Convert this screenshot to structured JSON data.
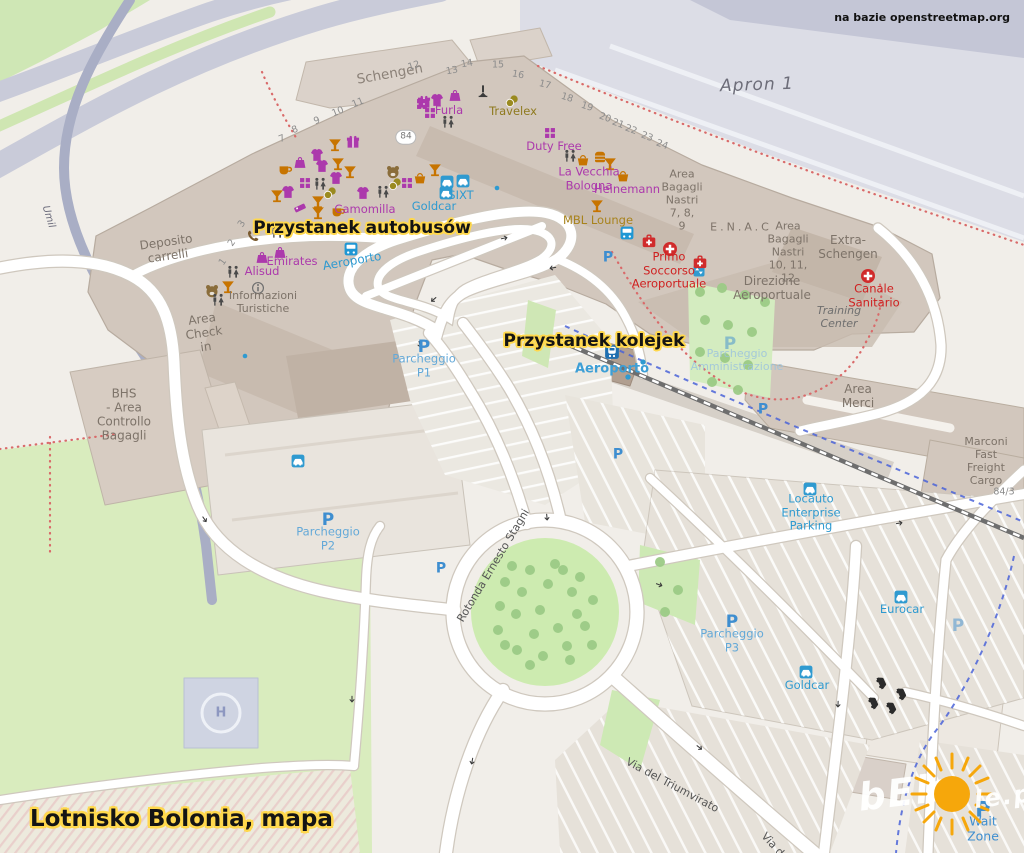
{
  "title": "Lotnisko Bolonia, mapa",
  "attribution": "na bazie openstreetmap.org",
  "annotations": {
    "bus_stop": "Przystanek autobusów",
    "train_stop": "Przystanek kolejek"
  },
  "watermark": {
    "left": "bEls",
    "right": "le.pl",
    "sun_color": "#f6a70b"
  },
  "map": {
    "labels": [
      {
        "id": "schengen",
        "text": "Schengen",
        "x": 390,
        "y": 75,
        "cls": "b-lg",
        "rot": -10
      },
      {
        "id": "deposito-carrelli",
        "text": "Deposito\ncarrelli",
        "x": 167,
        "y": 249,
        "cls": "b",
        "rot": -8
      },
      {
        "id": "area-check-in",
        "text": "Area\nCheck\nin",
        "x": 204,
        "y": 333,
        "cls": "b",
        "rot": -8
      },
      {
        "id": "informazioni-turistiche",
        "text": "Informazioni\nTuristiche",
        "x": 263,
        "y": 303,
        "cls": "b-sm"
      },
      {
        "id": "bhs-area-controllo-bagagli",
        "text": "BHS\n- Area\nControllo\nBagagli",
        "x": 124,
        "y": 415,
        "cls": "b"
      },
      {
        "id": "area-bagagli-nastri-789",
        "text": "Area\nBagagli\nNastri\n7, 8,\n9",
        "x": 682,
        "y": 201,
        "cls": "b-sm"
      },
      {
        "id": "enac",
        "text": "E.N.A.C",
        "x": 741,
        "y": 228,
        "cls": "b-sp"
      },
      {
        "id": "area-bagagli-nastri-101112",
        "text": "Area\nBagagli\nNastri\n10, 11,\n12",
        "x": 788,
        "y": 253,
        "cls": "b-sm"
      },
      {
        "id": "extra-schengen",
        "text": "Extra-\nSchengen",
        "x": 848,
        "y": 247,
        "cls": "b"
      },
      {
        "id": "direzione-aeroportuale",
        "text": "Direzione\nAeroportuale",
        "x": 772,
        "y": 288,
        "cls": "b"
      },
      {
        "id": "training-center",
        "text": "Training\nCenter",
        "x": 839,
        "y": 318,
        "cls": "b-it"
      },
      {
        "id": "area-merci",
        "text": "Area\nMerci",
        "x": 858,
        "y": 396,
        "cls": "b"
      },
      {
        "id": "marconi-fast-freight-cargo",
        "text": "Marconi\nFast\nFreight\nCargo",
        "x": 986,
        "y": 462,
        "cls": "b-sm"
      },
      {
        "id": "apron-1",
        "text": "Apron 1",
        "x": 757,
        "y": 85,
        "cls": "apron",
        "rot": -2
      },
      {
        "id": "ref-84",
        "text": "84",
        "x": 406,
        "y": 137,
        "cls": "refbadge"
      },
      {
        "id": "ref-84-3",
        "text": "84/3",
        "x": 1004,
        "y": 492,
        "cls": "ref-sm"
      },
      {
        "id": "via-del-triumvirato",
        "text": "Via del Triumvirato",
        "x": 672,
        "y": 786,
        "cls": "road",
        "rot": 28
      },
      {
        "id": "rotonda-ernesto-stagni",
        "text": "Rotonda Ernesto Stagni",
        "x": 494,
        "y": 566,
        "cls": "road",
        "rot": -59
      },
      {
        "id": "umil-road",
        "text": "Umil",
        "x": 48,
        "y": 217,
        "cls": "road-it",
        "rot": 73
      },
      {
        "id": "via-d",
        "text": "Via d",
        "x": 772,
        "y": 845,
        "cls": "road",
        "rot": 48
      },
      {
        "id": "wait-zone",
        "text": "Wait Zone",
        "x": 983,
        "y": 829,
        "cls": "blue-lbl"
      },
      {
        "id": "furla",
        "text": "Furla",
        "x": 449,
        "y": 111,
        "cls": "shop"
      },
      {
        "id": "duty-free",
        "text": "Duty Free",
        "x": 554,
        "y": 147,
        "cls": "shop"
      },
      {
        "id": "la-vecchia-bologna",
        "text": "La Vecchia\nBologna",
        "x": 589,
        "y": 179,
        "cls": "shop"
      },
      {
        "id": "heinemann",
        "text": "Heinemann",
        "x": 627,
        "y": 190,
        "cls": "shop"
      },
      {
        "id": "camomilla",
        "text": "Camomilla",
        "x": 365,
        "y": 210,
        "cls": "shop"
      },
      {
        "id": "emirates",
        "text": "Emirates",
        "x": 292,
        "y": 262,
        "cls": "shop"
      },
      {
        "id": "alisud",
        "text": "Alisud",
        "x": 262,
        "y": 272,
        "cls": "shop"
      },
      {
        "id": "travelex",
        "text": "Travelex",
        "x": 513,
        "y": 112,
        "cls": "money"
      },
      {
        "id": "mbl-lounge",
        "text": "MBL Lounge",
        "x": 598,
        "y": 221,
        "cls": "gold"
      },
      {
        "id": "sixt",
        "text": "SIXT",
        "x": 461,
        "y": 196,
        "cls": "rental"
      },
      {
        "id": "goldcar-terminal",
        "text": "Goldcar",
        "x": 434,
        "y": 207,
        "cls": "rental"
      },
      {
        "id": "locauto-enterprise-parking",
        "text": "Locauto\nEnterprise\nParking",
        "x": 811,
        "y": 513,
        "cls": "rental"
      },
      {
        "id": "eurocar",
        "text": "Eurocar",
        "x": 902,
        "y": 610,
        "cls": "rental"
      },
      {
        "id": "goldcar-south",
        "text": "Goldcar",
        "x": 807,
        "y": 686,
        "cls": "rental"
      },
      {
        "id": "aeroporto-bus-stop",
        "text": "Aeroporto",
        "x": 352,
        "y": 261,
        "cls": "transit",
        "rot": -10
      },
      {
        "id": "aeroporto-train-station",
        "text": "Aeroporto",
        "x": 612,
        "y": 369,
        "cls": "transit-lg"
      },
      {
        "id": "parcheggio-p1",
        "text": "Parcheggio\nP1",
        "x": 424,
        "y": 366,
        "cls": "park"
      },
      {
        "id": "parcheggio-p2",
        "text": "Parcheggio\nP2",
        "x": 328,
        "y": 539,
        "cls": "park"
      },
      {
        "id": "parcheggio-p3",
        "text": "Parcheggio\nP3",
        "x": 732,
        "y": 641,
        "cls": "park"
      },
      {
        "id": "parcheggio-amministrazione",
        "text": "Parcheggio\nAmministrazione",
        "x": 737,
        "y": 361,
        "cls": "park-faint"
      },
      {
        "id": "primo-soccorso-aeroportuale",
        "text": "Primo\nSoccorso\nAeroportuale",
        "x": 669,
        "y": 271,
        "cls": "med"
      },
      {
        "id": "canale-sanitario",
        "text": "Canale\nSanitario",
        "x": 874,
        "y": 296,
        "cls": "med"
      },
      {
        "id": "helipad-h",
        "text": "H",
        "x": 221,
        "y": 713,
        "cls": "heli"
      },
      {
        "id": "p-icon-p1",
        "text": "P",
        "x": 424,
        "y": 347,
        "cls": "picon"
      },
      {
        "id": "p-icon-p2",
        "text": "P",
        "x": 328,
        "y": 520,
        "cls": "picon"
      },
      {
        "id": "p-icon-p3",
        "text": "P",
        "x": 732,
        "y": 622,
        "cls": "picon"
      },
      {
        "id": "p-icon-wait-zone",
        "text": "P",
        "x": 983,
        "y": 810,
        "cls": "picon picon-lg"
      },
      {
        "id": "p-icon-admin",
        "text": "P",
        "x": 730,
        "y": 344,
        "cls": "picon picon-faint"
      },
      {
        "id": "p-icon-station",
        "text": "P",
        "x": 608,
        "y": 258,
        "cls": "picon picon-sm"
      },
      {
        "id": "p-icon-merci",
        "text": "P",
        "x": 763,
        "y": 410,
        "cls": "picon picon-sm"
      },
      {
        "id": "p-icon-mid-lot",
        "text": "P",
        "x": 618,
        "y": 455,
        "cls": "picon picon-sm"
      },
      {
        "id": "p-icon-p2-west",
        "text": "P",
        "x": 441,
        "y": 569,
        "cls": "picon picon-sm"
      },
      {
        "id": "p-icon-rental-depot",
        "text": "P",
        "x": 958,
        "y": 626,
        "cls": "picon picon-faint"
      }
    ],
    "gates": [
      {
        "n": "1",
        "x": 223,
        "y": 262,
        "r": -55
      },
      {
        "n": "2",
        "x": 232,
        "y": 243,
        "r": -55
      },
      {
        "n": "3",
        "x": 242,
        "y": 224,
        "r": -55
      },
      {
        "n": "7",
        "x": 282,
        "y": 139,
        "r": -22
      },
      {
        "n": "8",
        "x": 295,
        "y": 130,
        "r": -22
      },
      {
        "n": "9",
        "x": 317,
        "y": 121,
        "r": -22
      },
      {
        "n": "10",
        "x": 338,
        "y": 112,
        "r": -22
      },
      {
        "n": "11",
        "x": 358,
        "y": 103,
        "r": -22
      },
      {
        "n": "12",
        "x": 414,
        "y": 66,
        "r": -18
      },
      {
        "n": "13",
        "x": 452,
        "y": 71,
        "r": -10
      },
      {
        "n": "14",
        "x": 467,
        "y": 64,
        "r": -10
      },
      {
        "n": "15",
        "x": 498,
        "y": 65,
        "r": 0
      },
      {
        "n": "16",
        "x": 518,
        "y": 75,
        "r": 10
      },
      {
        "n": "17",
        "x": 545,
        "y": 85,
        "r": 14
      },
      {
        "n": "18",
        "x": 567,
        "y": 98,
        "r": 18
      },
      {
        "n": "19",
        "x": 587,
        "y": 107,
        "r": 18
      },
      {
        "n": "20",
        "x": 605,
        "y": 118,
        "r": 20
      },
      {
        "n": "21",
        "x": 618,
        "y": 124,
        "r": 20
      },
      {
        "n": "22",
        "x": 631,
        "y": 130,
        "r": 20
      },
      {
        "n": "23",
        "x": 647,
        "y": 137,
        "r": 20
      },
      {
        "n": "24",
        "x": 662,
        "y": 145,
        "r": 20
      }
    ],
    "icons": [
      {
        "t": "gift",
        "x": 353,
        "y": 142,
        "c": "#ac39ac"
      },
      {
        "t": "gift",
        "x": 424,
        "y": 102,
        "c": "#ac39ac"
      },
      {
        "t": "shirt",
        "x": 317,
        "y": 155,
        "c": "#ac39ac"
      },
      {
        "t": "shirt",
        "x": 322,
        "y": 166,
        "c": "#ac39ac"
      },
      {
        "t": "shirt",
        "x": 336,
        "y": 178,
        "c": "#ac39ac"
      },
      {
        "t": "shirt",
        "x": 288,
        "y": 192,
        "c": "#ac39ac"
      },
      {
        "t": "shirt",
        "x": 363,
        "y": 193,
        "c": "#ac39ac"
      },
      {
        "t": "shirt",
        "x": 437,
        "y": 100,
        "c": "#ac39ac"
      },
      {
        "t": "bag",
        "x": 300,
        "y": 162,
        "c": "#ac39ac"
      },
      {
        "t": "bag",
        "x": 455,
        "y": 95,
        "c": "#ac39ac"
      },
      {
        "t": "bag",
        "x": 280,
        "y": 252,
        "c": "#ac39ac"
      },
      {
        "t": "bag",
        "x": 262,
        "y": 257,
        "c": "#ac39ac"
      },
      {
        "t": "grid",
        "x": 305,
        "y": 183,
        "c": "#ac39ac",
        "s": 11
      },
      {
        "t": "grid",
        "x": 407,
        "y": 183,
        "c": "#ac39ac",
        "s": 11
      },
      {
        "t": "grid",
        "x": 422,
        "y": 104,
        "c": "#ac39ac",
        "s": 11
      },
      {
        "t": "grid",
        "x": 430,
        "y": 113,
        "c": "#ac39ac",
        "s": 11
      },
      {
        "t": "grid",
        "x": 550,
        "y": 133,
        "c": "#ac39ac",
        "s": 11
      },
      {
        "t": "tag",
        "x": 300,
        "y": 208,
        "c": "#ac39ac"
      },
      {
        "t": "cocktail",
        "x": 335,
        "y": 145,
        "c": "#c77400"
      },
      {
        "t": "cocktail",
        "x": 338,
        "y": 164,
        "c": "#c77400"
      },
      {
        "t": "cocktail",
        "x": 350,
        "y": 172,
        "c": "#c77400"
      },
      {
        "t": "cocktail",
        "x": 277,
        "y": 196,
        "c": "#c77400"
      },
      {
        "t": "cocktail",
        "x": 318,
        "y": 202,
        "c": "#c77400"
      },
      {
        "t": "cocktail",
        "x": 318,
        "y": 213,
        "c": "#c77400"
      },
      {
        "t": "cocktail",
        "x": 228,
        "y": 287,
        "c": "#c77400"
      },
      {
        "t": "cocktail",
        "x": 435,
        "y": 170,
        "c": "#c77400"
      },
      {
        "t": "cocktail",
        "x": 597,
        "y": 206,
        "c": "#c77400"
      },
      {
        "t": "cocktail",
        "x": 610,
        "y": 164,
        "c": "#c77400"
      },
      {
        "t": "cup",
        "x": 285,
        "y": 169,
        "c": "#c77400"
      },
      {
        "t": "cup",
        "x": 338,
        "y": 211,
        "c": "#c77400"
      },
      {
        "t": "basket",
        "x": 420,
        "y": 178,
        "c": "#c77400",
        "s": 12
      },
      {
        "t": "basket",
        "x": 583,
        "y": 160,
        "c": "#c77400",
        "s": 12
      },
      {
        "t": "basket",
        "x": 623,
        "y": 176,
        "c": "#c77400",
        "s": 12
      },
      {
        "t": "burger",
        "x": 600,
        "y": 157,
        "c": "#c77400",
        "s": 12
      },
      {
        "t": "bear",
        "x": 393,
        "y": 172,
        "c": "#8a6d3b",
        "s": 15
      },
      {
        "t": "bear",
        "x": 212,
        "y": 291,
        "c": "#8a6d3b",
        "s": 15
      },
      {
        "t": "coins",
        "x": 330,
        "y": 193,
        "c": "#9a8a1f"
      },
      {
        "t": "coins",
        "x": 395,
        "y": 184,
        "c": "#9a8a1f"
      },
      {
        "t": "coins",
        "x": 512,
        "y": 101,
        "c": "#9a8a1f"
      },
      {
        "t": "wc",
        "x": 320,
        "y": 184,
        "c": "#4a4a4a"
      },
      {
        "t": "wc",
        "x": 383,
        "y": 192,
        "c": "#4a4a4a"
      },
      {
        "t": "wc",
        "x": 448,
        "y": 122,
        "c": "#4a4a4a"
      },
      {
        "t": "wc",
        "x": 570,
        "y": 156,
        "c": "#4a4a4a"
      },
      {
        "t": "wc",
        "x": 277,
        "y": 232,
        "c": "#4a4a4a"
      },
      {
        "t": "wc",
        "x": 233,
        "y": 272,
        "c": "#4a4a4a"
      },
      {
        "t": "wc",
        "x": 218,
        "y": 300,
        "c": "#4a4a4a"
      },
      {
        "t": "phone",
        "x": 253,
        "y": 236,
        "c": "#7a5b30"
      },
      {
        "t": "monument",
        "x": 483,
        "y": 91,
        "c": "#3a3a3a"
      },
      {
        "t": "info",
        "x": 258,
        "y": 288,
        "c": "#6f6f6f"
      },
      {
        "t": "bus",
        "x": 351,
        "y": 249,
        "c": "#1f97d4",
        "s": 14
      },
      {
        "t": "bus",
        "x": 627,
        "y": 233,
        "c": "#1f97d4",
        "s": 14
      },
      {
        "t": "train",
        "x": 612,
        "y": 352,
        "c": "#1f6fb0",
        "s": 15
      },
      {
        "t": "lift",
        "x": 699,
        "y": 271,
        "c": "#2f9ad0",
        "s": 12
      },
      {
        "t": "cross",
        "x": 670,
        "y": 249,
        "c": "#d02b2b",
        "s": 15
      },
      {
        "t": "cross",
        "x": 868,
        "y": 276,
        "c": "#d02b2b",
        "s": 15
      },
      {
        "t": "kit",
        "x": 649,
        "y": 241,
        "c": "#d02b2b",
        "s": 14
      },
      {
        "t": "kit",
        "x": 700,
        "y": 262,
        "c": "#d02b2b",
        "s": 14
      },
      {
        "t": "car",
        "x": 447,
        "y": 182,
        "c": "#2f9ad0",
        "s": 14
      },
      {
        "t": "car",
        "x": 463,
        "y": 181,
        "c": "#2f9ad0",
        "s": 14
      },
      {
        "t": "car",
        "x": 446,
        "y": 193,
        "c": "#2f9ad0",
        "s": 14
      },
      {
        "t": "car",
        "x": 298,
        "y": 461,
        "c": "#2f9ad0",
        "s": 14
      },
      {
        "t": "car",
        "x": 810,
        "y": 489,
        "c": "#2f9ad0",
        "s": 14
      },
      {
        "t": "car",
        "x": 901,
        "y": 597,
        "c": "#2f9ad0",
        "s": 14
      },
      {
        "t": "car",
        "x": 806,
        "y": 672,
        "c": "#2f9ad0",
        "s": 14
      },
      {
        "t": "carblack",
        "x": 883,
        "y": 682,
        "c": "#2b2b2b",
        "s": 13,
        "r": 65
      },
      {
        "t": "carblack",
        "x": 903,
        "y": 693,
        "c": "#2b2b2b",
        "s": 13,
        "r": 65
      },
      {
        "t": "carblack",
        "x": 875,
        "y": 702,
        "c": "#2b2b2b",
        "s": 13,
        "r": 65
      },
      {
        "t": "carblack",
        "x": 893,
        "y": 707,
        "c": "#2b2b2b",
        "s": 13,
        "r": 65
      },
      {
        "t": "dot",
        "x": 497,
        "y": 188,
        "c": "#2f9ad0",
        "s": 6
      },
      {
        "t": "dot",
        "x": 245,
        "y": 356,
        "c": "#2f9ad0",
        "s": 6
      },
      {
        "t": "dot",
        "x": 643,
        "y": 362,
        "c": "#2f9ad0",
        "s": 7
      },
      {
        "t": "dot",
        "x": 628,
        "y": 377,
        "c": "#2f9ad0",
        "s": 7
      },
      {
        "t": "arrow",
        "x": 433,
        "y": 300,
        "c": "#3a3a3a",
        "s": 9,
        "r": 140
      },
      {
        "t": "arrow",
        "x": 505,
        "y": 238,
        "c": "#3a3a3a",
        "s": 9,
        "r": -12
      },
      {
        "t": "arrow",
        "x": 552,
        "y": 268,
        "c": "#3a3a3a",
        "s": 9,
        "r": 170
      },
      {
        "t": "arrow",
        "x": 420,
        "y": 345,
        "c": "#3a3a3a",
        "s": 9,
        "r": 75
      },
      {
        "t": "arrow",
        "x": 547,
        "y": 518,
        "c": "#3a3a3a",
        "s": 9,
        "r": 85
      },
      {
        "t": "arrow",
        "x": 472,
        "y": 762,
        "c": "#3a3a3a",
        "s": 9,
        "r": 100
      },
      {
        "t": "arrow",
        "x": 700,
        "y": 748,
        "c": "#3a3a3a",
        "s": 9,
        "r": 38
      },
      {
        "t": "arrow",
        "x": 838,
        "y": 705,
        "c": "#3a3a3a",
        "s": 9,
        "r": 92
      },
      {
        "t": "arrow",
        "x": 900,
        "y": 523,
        "c": "#3a3a3a",
        "s": 9,
        "r": -10
      },
      {
        "t": "arrow",
        "x": 205,
        "y": 520,
        "c": "#3a3a3a",
        "s": 9,
        "r": 55
      },
      {
        "t": "arrow",
        "x": 352,
        "y": 700,
        "c": "#3a3a3a",
        "s": 9,
        "r": 90
      },
      {
        "t": "arrow",
        "x": 660,
        "y": 585,
        "c": "#3a3a3a",
        "s": 9,
        "r": 20
      }
    ]
  }
}
